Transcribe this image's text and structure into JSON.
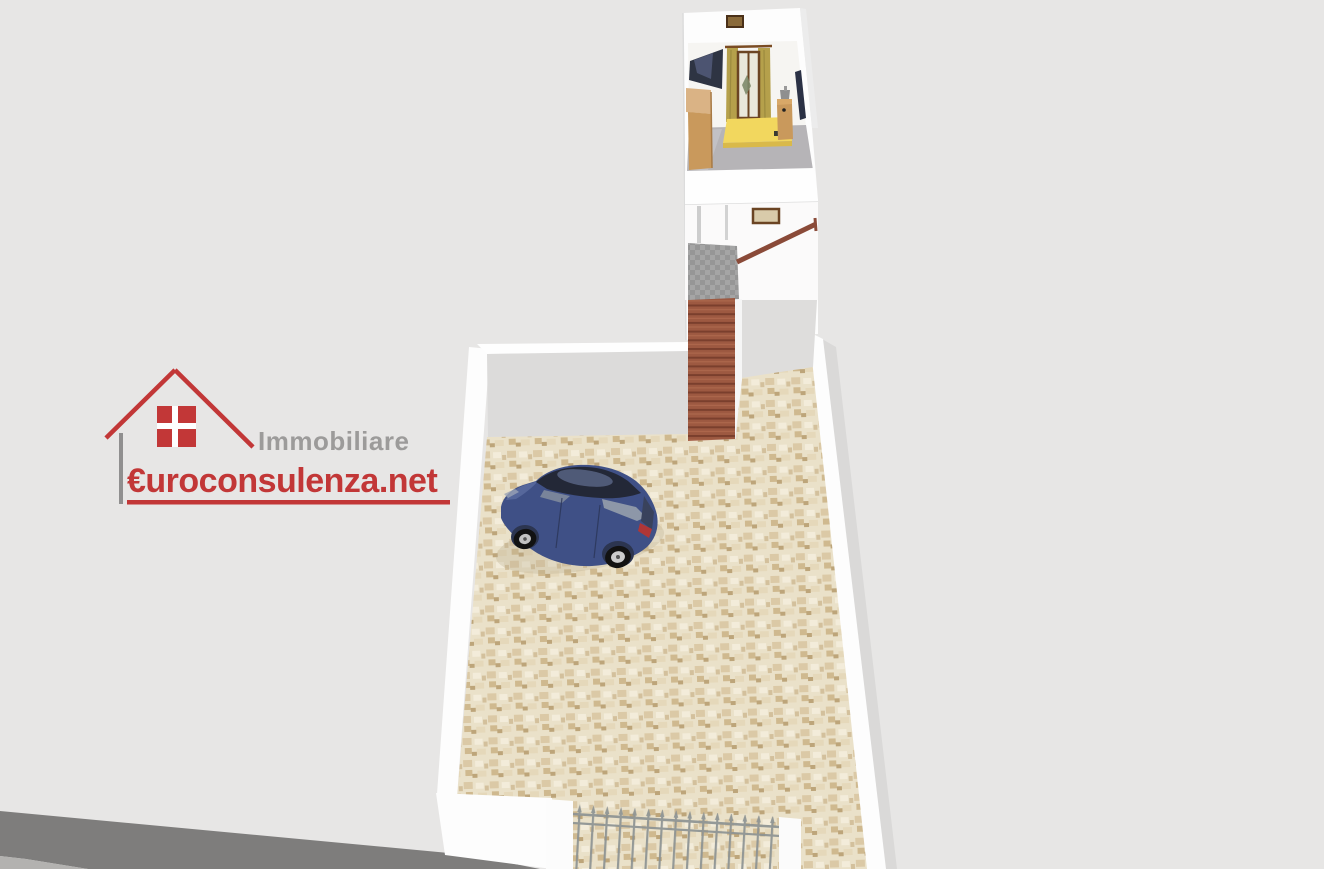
{
  "watermark": {
    "line1": "Immobiliare",
    "line2": "€uroconsulenza.net",
    "icon": "house-icon"
  },
  "colors": {
    "background": "#e7e6e5",
    "wall_white": "#fdfdfd",
    "wall_inner_gray": "#dcdbda",
    "wall_inner_gray2": "#dedddc",
    "courtyard_floor": "#eae1c9",
    "stair_brick": "#9d5941",
    "stair_step_shadow": "#7a3f2d",
    "landing_gray": "#a5a5a5",
    "landing_gray2": "#969696",
    "railing_brown": "#8a4a38",
    "street_gray": "#7e7d7c",
    "curb_light_gray": "#b3b2b0",
    "gate_metal": "#8d9393",
    "car_body_blue": "#3f5086",
    "car_glass_dark": "#232837",
    "bed_yellow": "#f2d75e",
    "curtain_olive": "#b5a04b",
    "wood_light": "#c9995c",
    "wood_lighter": "#dab385",
    "bedroom_floor": "#b6b4b7",
    "frame_brown": "#6b4423",
    "tv_dark": "#2e3443",
    "logo_red": "#c13232",
    "logo_gray": "#9a9998",
    "logo_line_gray": "#8e8d8d"
  },
  "scene": {
    "type": "3d-floorplan-render",
    "objects": [
      "bedroom",
      "staircase",
      "stair-landing",
      "stair-railing",
      "courtyard",
      "parked-car",
      "entrance-gate",
      "gate-pillars",
      "boundary-walls",
      "street"
    ]
  }
}
